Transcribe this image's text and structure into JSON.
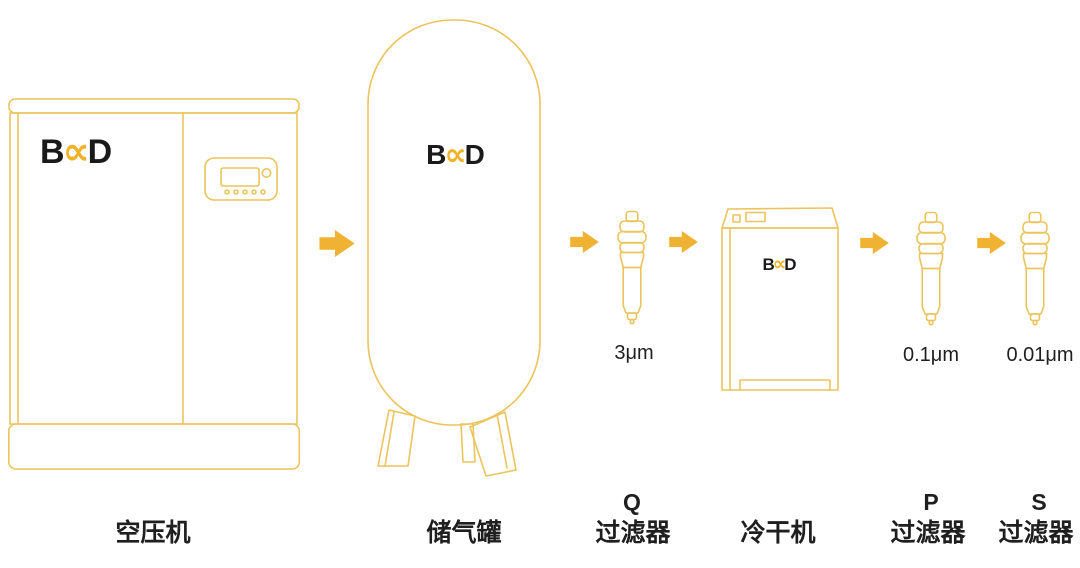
{
  "brand": {
    "b": "B",
    "x": "∝",
    "d": "D"
  },
  "colors": {
    "outline_yellow": "#ECC45C",
    "arrow_yellow": "#F0B232",
    "logo_yellow": "#F2B227",
    "logo_dark": "#1A1A1A",
    "text": "#1F1F1F",
    "background": "#FFFFFF"
  },
  "stages": {
    "compressor": {
      "label": "空压机"
    },
    "tank": {
      "label": "储气罐"
    },
    "filter_q": {
      "letter": "Q",
      "label": "过滤器",
      "rating": "3μm"
    },
    "dryer": {
      "label": "冷干机"
    },
    "filter_p": {
      "letter": "P",
      "label": "过滤器",
      "rating": "0.1μm"
    },
    "filter_s": {
      "letter": "S",
      "label": "过滤器",
      "rating": "0.01μm"
    }
  }
}
